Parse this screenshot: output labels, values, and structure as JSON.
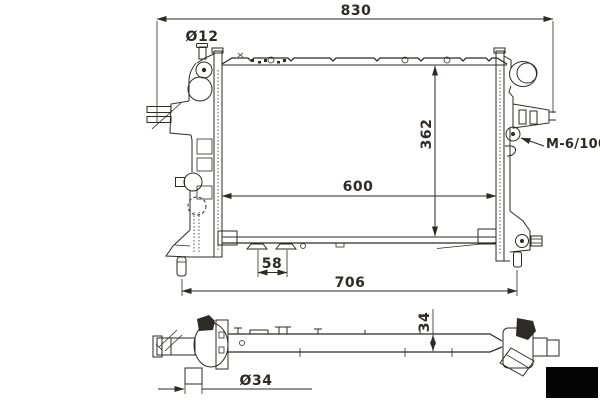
{
  "colors": {
    "ink": "#2e2a26",
    "paper": "#ffffff",
    "watermark": "#050505"
  },
  "drawing": {
    "dims": {
      "overall_width": "830",
      "core_width": "600",
      "core_height": "362",
      "pin_span": "706",
      "bracket_pitch": "58",
      "bleed_pipe": "Ø12",
      "outlet_pipe": "Ø34",
      "core_depth": "34",
      "thread": "M-6/100"
    }
  }
}
